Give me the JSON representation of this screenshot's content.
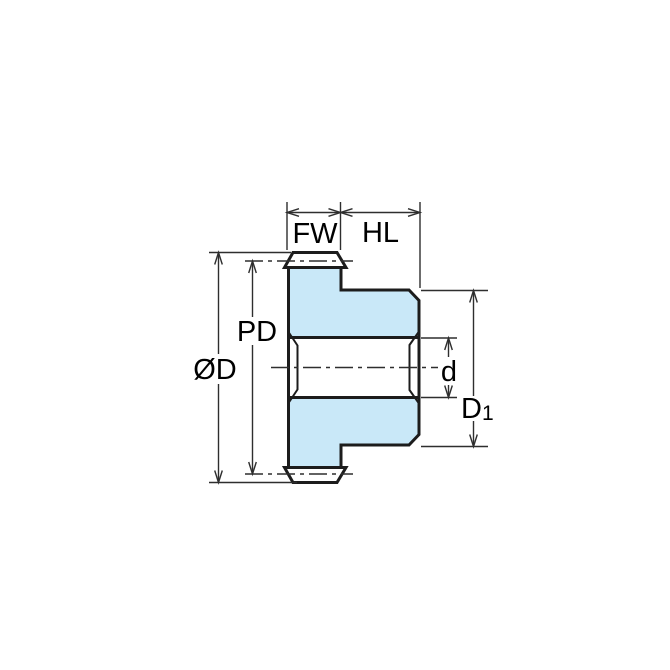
{
  "diagram": {
    "labels": {
      "fw": "FW",
      "hl": "HL",
      "pd": "PD",
      "od": "ØD",
      "d": "d",
      "d1_base": "D",
      "d1_sub": "1"
    },
    "colors": {
      "background": "#ffffff",
      "part_fill": "#c9e8f8",
      "outline": "#1c1c1c",
      "dim_line": "#2e2e2e",
      "text": "#000000"
    }
  }
}
